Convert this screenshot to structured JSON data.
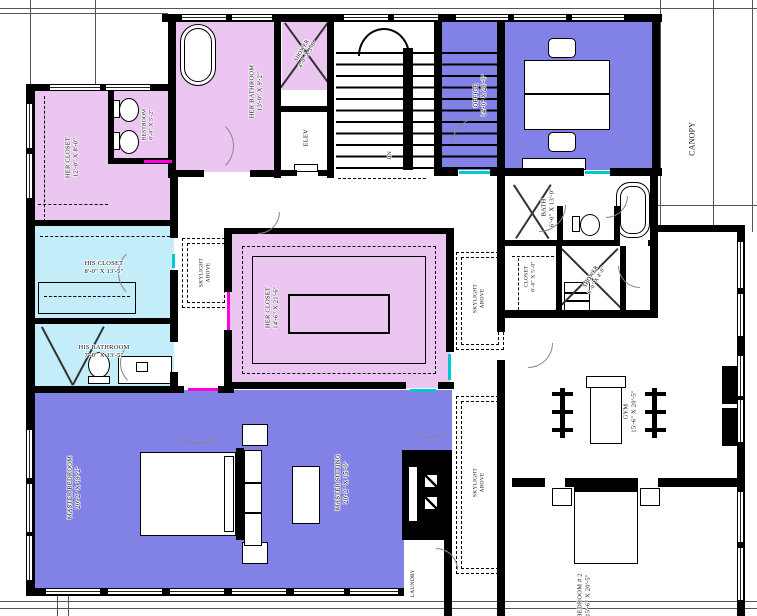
{
  "rooms": {
    "her_closet_top": {
      "name": "HER CLOSET",
      "dims": "12'-0\" X 8'-0\""
    },
    "restroom": {
      "name": "RESTROOM",
      "dims": "6'-0\" X 5'-2\""
    },
    "her_bathroom": {
      "name": "HER BATHROOM",
      "dims": "13'-0\" X 9'-2\""
    },
    "shower_upper": {
      "name": "SHOWER",
      "dims": "4'-0\" X 3'-6\""
    },
    "elevator": {
      "name": "ELEV"
    },
    "stairs": {
      "name": "DN"
    },
    "office": {
      "name": "OFFICE",
      "dims": "14'-0\" X 20'-0\""
    },
    "canopy": {
      "name": "CANOPY"
    },
    "bath": {
      "name": "BATH",
      "dims": "6'-0\" X 13'-0\""
    },
    "closet": {
      "name": "CLOSET",
      "dims": "6'-0\" X 5'-0\""
    },
    "shower_lower": {
      "name": "SHOWER",
      "dims": "6'-0\" X 4'-0\""
    },
    "his_closet": {
      "name": "HIS CLOSET",
      "dims": "8'-0\" X 13'-5\""
    },
    "his_bathroom": {
      "name": "HIS BATHROOM",
      "dims": "7'-0\" X 13'-5\""
    },
    "her_closet_main": {
      "name": "HER CLOSET",
      "dims": "14'-6\" X 21'-6\""
    },
    "master_bedroom": {
      "name": "MASTER BEDROOM",
      "dims": "20'-2\" X 19'-2\""
    },
    "master_sitting": {
      "name": "MASTER SITTING",
      "dims": "20'-2\" X 15'-0\""
    },
    "gym": {
      "name": "GYM",
      "dims": "15'-6\" X 20'-5\""
    },
    "bedroom_2": {
      "name": "BEDROOM # 2",
      "dims": "15'-6\" X 20'-5\""
    },
    "laundry": {
      "name": "LAUNDRY"
    },
    "tv": {
      "name": "TV"
    },
    "skylight": {
      "name": "SKYLIGHT",
      "dims": "ABOVE"
    }
  },
  "colors": {
    "master_suite_fill": "#8181e6",
    "her_fill": "#eac6f1",
    "his_fill": "#c2edf9",
    "wall": "#000000",
    "threshold_magenta": "#ff00dd",
    "threshold_cyan": "#00c8d2",
    "background": "#ffffff"
  }
}
